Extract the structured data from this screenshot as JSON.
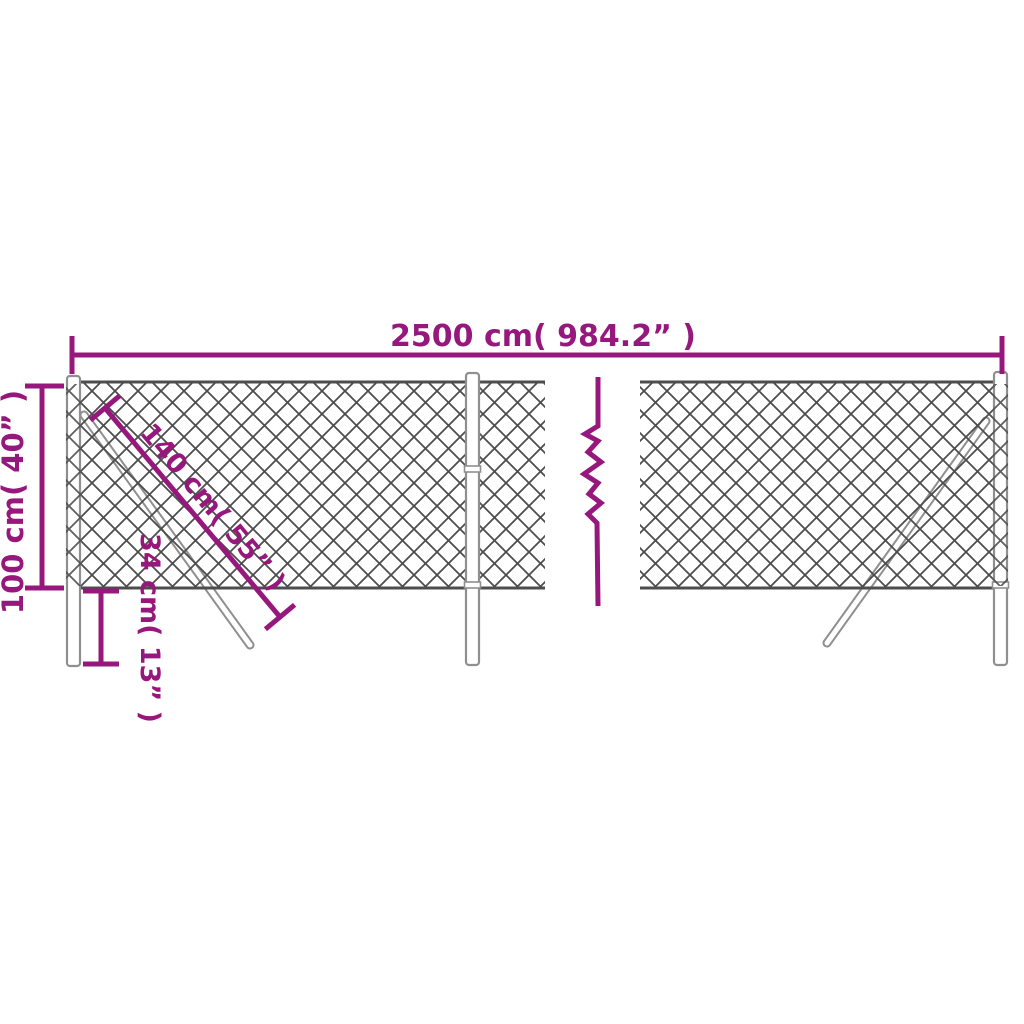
{
  "page": {
    "type": "product-dimension-diagram",
    "subject": "chain-link fence kit with posts and support braces, shown with a break symbol indicating continued length"
  },
  "colors": {
    "accent": "#97187c",
    "mesh": "#4d4d4d",
    "hardware": "#8f8f8f",
    "background": "#ffffff"
  },
  "dimensions": {
    "width": {
      "label": "2500 cm( 984.2” )"
    },
    "height": {
      "label": "100 cm( 40” )"
    },
    "brace_length": {
      "label": "140 cm( 55” )"
    },
    "post_depth": {
      "label": "34 cm( 13” )"
    }
  },
  "symbols": {
    "break": "zigzag-continuation-break"
  }
}
